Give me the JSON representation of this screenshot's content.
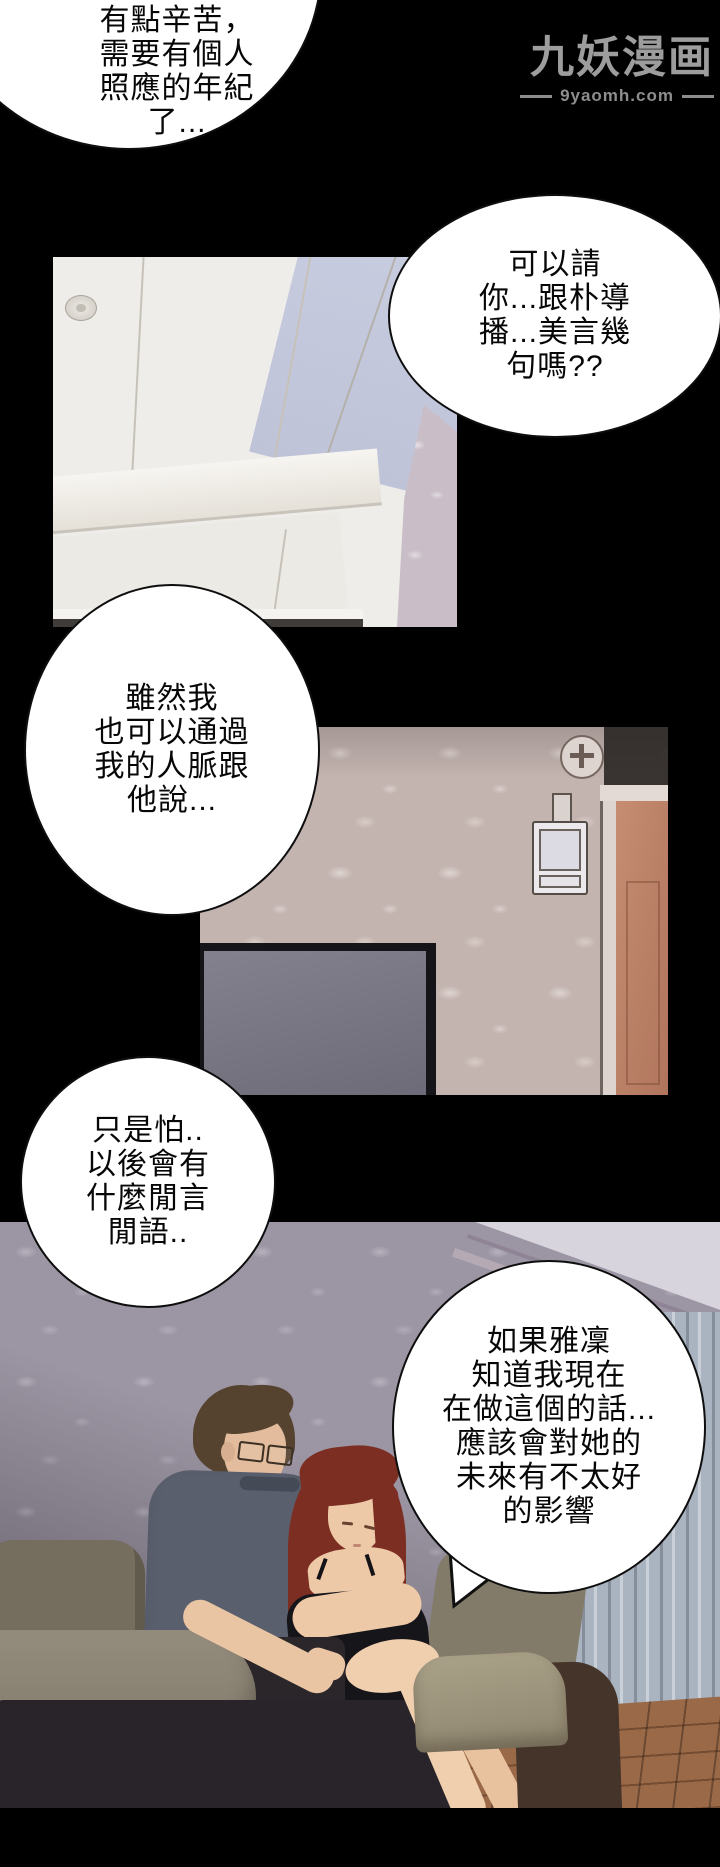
{
  "watermark": {
    "title": "九妖漫画",
    "site": "9yaomh.com"
  },
  "bubbles": [
    {
      "lines": [
        "我自己一個",
        "有點辛苦，",
        "需要有個人",
        "照應的年紀",
        "了..."
      ]
    },
    {
      "lines": [
        "可以請",
        "你...跟朴導",
        "播...美言幾",
        "句嗎??"
      ]
    },
    {
      "lines": [
        "雖然我",
        "也可以通過",
        "我的人脈跟",
        "他說..."
      ]
    },
    {
      "lines": [
        "只是怕..",
        "以後會有",
        "什麼閒言",
        "閒語.."
      ]
    },
    {
      "lines": [
        "如果雅凜",
        "知道我現在",
        "在做這個的話...",
        "應該會對她的",
        "未來有不太好",
        "的影響"
      ]
    }
  ],
  "colors": {
    "background": "#000000",
    "bubble_fill": "#ffffff",
    "bubble_border": "#111111",
    "bubble_text": "#070707",
    "watermark_text": "#9d9d9d",
    "ceiling": "#f0eeea",
    "ceiling_blue_panel": "#c4c8db",
    "room_wallpaper": "#c3b4b0",
    "door": "#bd8169",
    "tv_screen": "#7d7a88",
    "lounge_wallpaper": "#9c95a3",
    "curtain": "#aab3c0",
    "floor_wood": "#9a6a48",
    "couch_olive": "#8c8475",
    "couch_dark": "#28242a",
    "man_shirt": "#5a5f6e",
    "man_hair": "#55422f",
    "woman_hair": "#7c2e22",
    "woman_dress": "#16151a",
    "skin": "#ecc9a8"
  }
}
